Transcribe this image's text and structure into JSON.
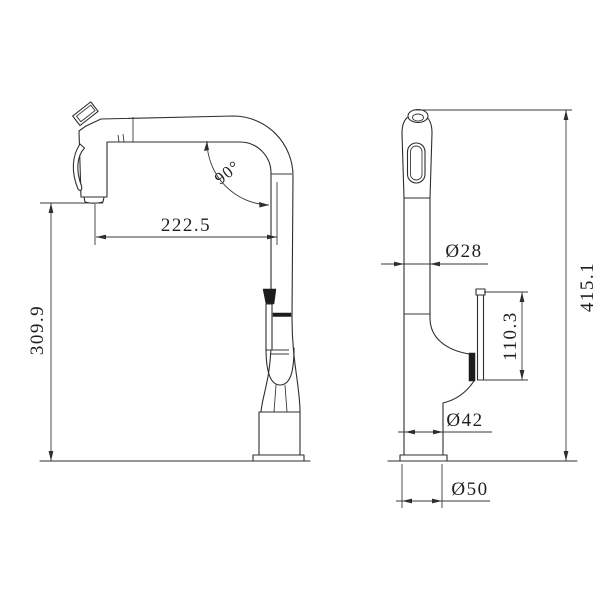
{
  "drawing": {
    "colors": {
      "background": "#ffffff",
      "line": "#2e2e2e",
      "text": "#1f1f1f"
    },
    "labels": {
      "spout_reach": "222.5",
      "spout_angle": "90°",
      "deck_to_spout_height": "309.9",
      "spout_pipe_diameter": "Ø28",
      "overall_height": "415.1",
      "handle_height": "110.3",
      "body_diameter": "Ø42",
      "base_diameter": "Ø50"
    }
  }
}
